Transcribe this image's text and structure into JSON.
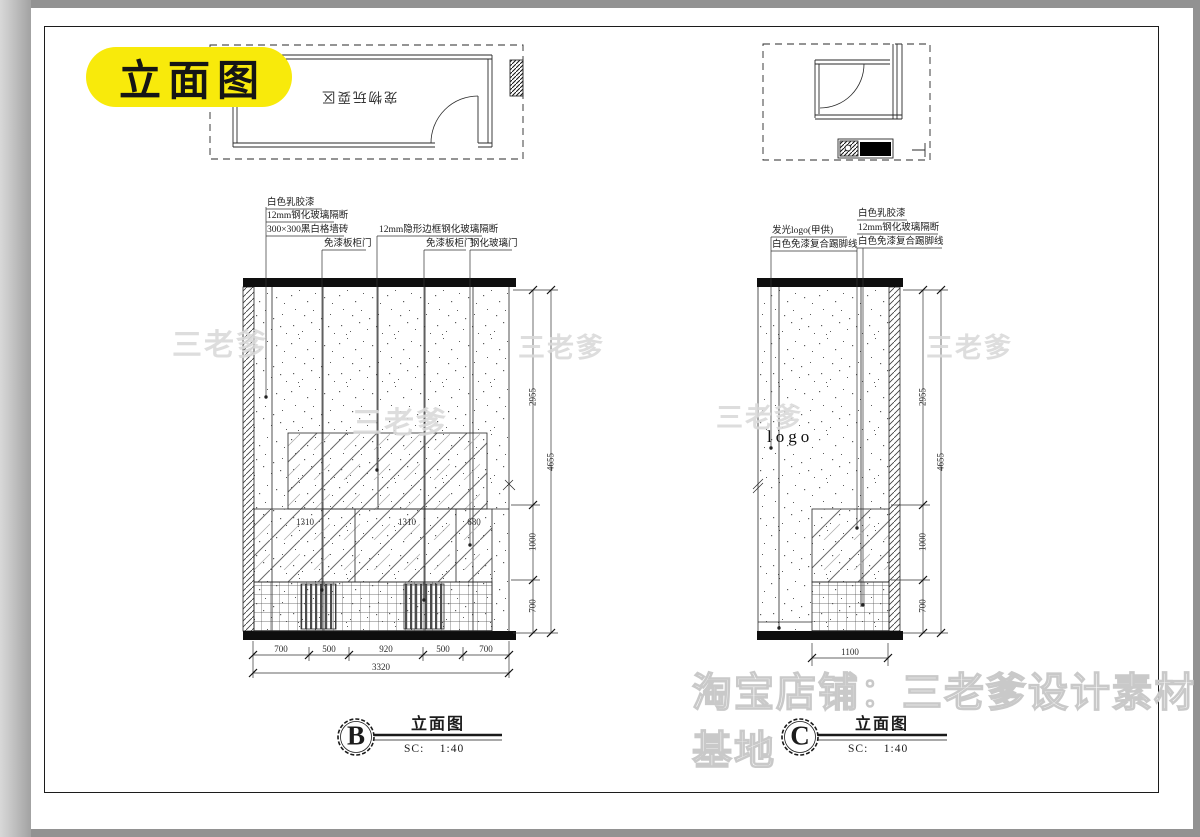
{
  "badge": "立面图",
  "plan_left": {
    "room_label": "宠物玩耍区"
  },
  "elev_b": {
    "label_paint": "白色乳胶漆",
    "label_glass12": "12mm钢化玻璃隔断",
    "label_tile": "300×300黑白格墙砖",
    "label_cab1": "免漆板柜门",
    "label_hidden": "12mm隐形边框钢化玻璃隔断",
    "label_cab2": "免漆板柜门",
    "label_glassdoor": "钢化玻璃门",
    "dim_v1": "2955",
    "dim_v2": "1000",
    "dim_v3": "700",
    "dim_vtotal": "4655",
    "dim_h1": "700",
    "dim_h2": "500",
    "dim_h3": "920",
    "dim_h4": "500",
    "dim_h5": "700",
    "dim_htotal": "3320",
    "dim_i1": "1310",
    "dim_i2": "1310",
    "dim_i3": "680",
    "title_letter": "B",
    "title_name": "立面图",
    "title_scale": "SC:    1:40"
  },
  "elev_c": {
    "label_logo": "发光logo(甲供)",
    "label_skirt_l": "白色免漆复合踢脚线",
    "label_paint": "白色乳胶漆",
    "label_glass12": "12mm钢化玻璃隔断",
    "label_skirt_r": "白色免漆复合踢脚线",
    "wall_logo": "logo",
    "dim_v1": "2955",
    "dim_v2": "1000",
    "dim_v3": "700",
    "dim_vtotal": "4655",
    "dim_h1": "1100",
    "title_letter": "C",
    "title_name": "立面图",
    "title_scale": "SC:    1:40"
  },
  "watermarks": {
    "diag": "三老爹",
    "bottom": "淘宝店铺：三老爹设计素材基地"
  }
}
